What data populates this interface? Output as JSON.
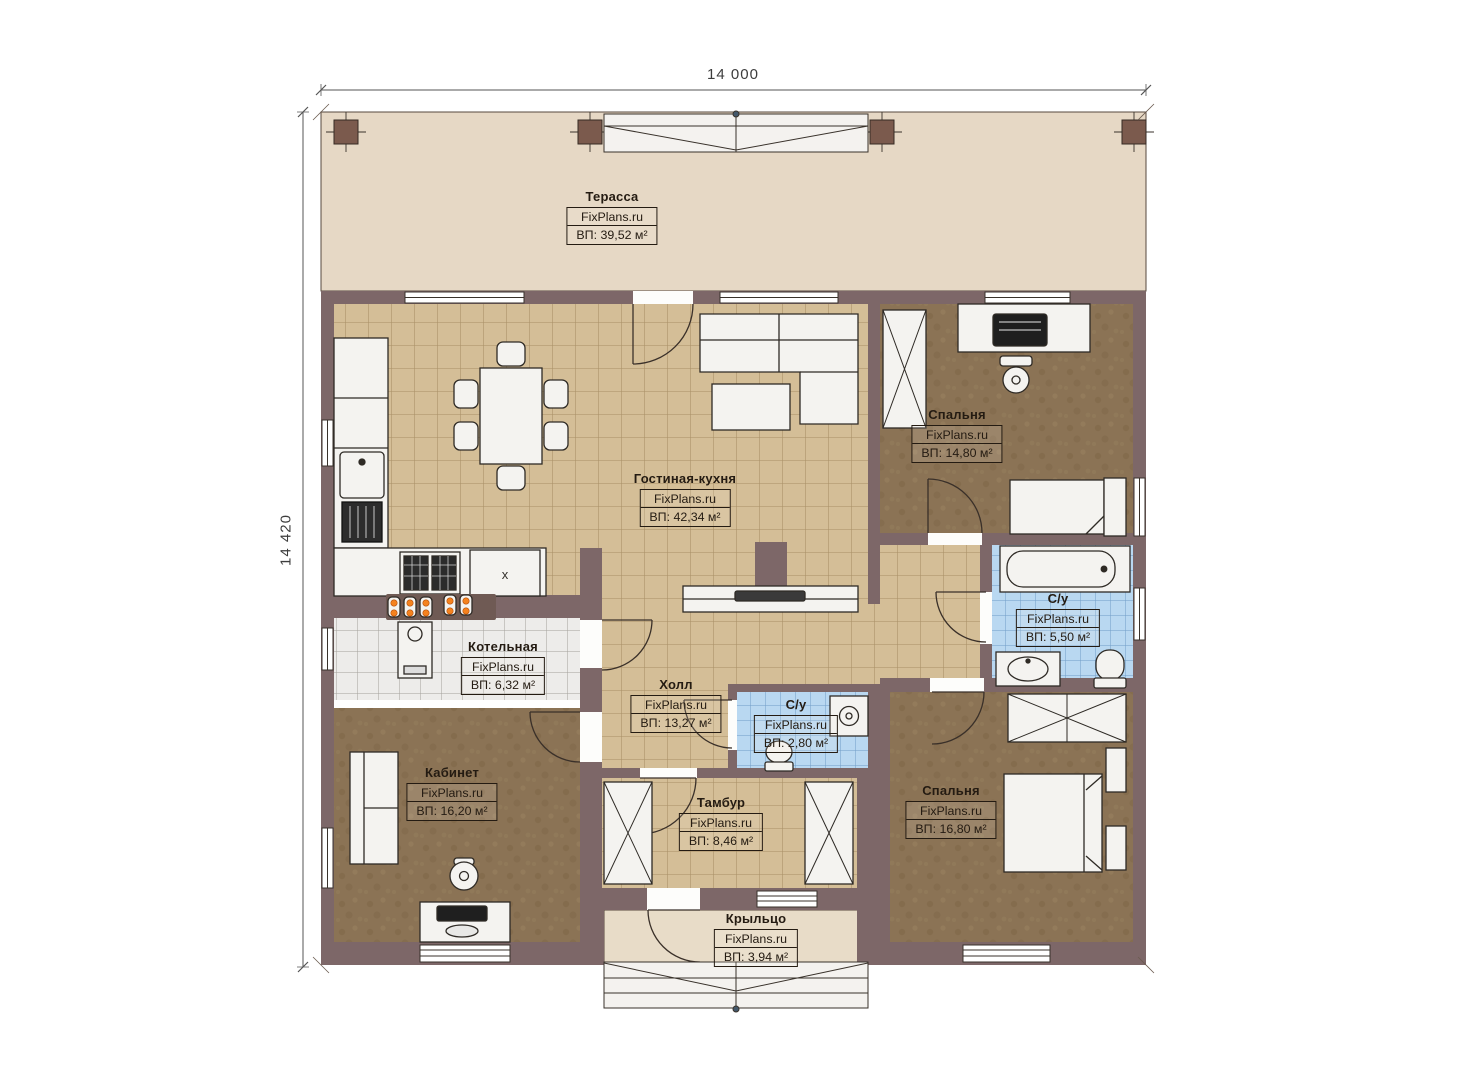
{
  "plan": {
    "watermark": "FixPlans.ru",
    "dimensions": {
      "width": "14 000",
      "height": "14 420"
    },
    "unit_mark": "x",
    "rooms": [
      {
        "id": "terrace",
        "name": "Терасса",
        "area": "ВП: 39,52 м²"
      },
      {
        "id": "living-kitchen",
        "name": "Гостиная-кухня",
        "area": "ВП: 42,34 м²"
      },
      {
        "id": "bedroom-top",
        "name": "Спальня",
        "area": "ВП: 14,80 м²"
      },
      {
        "id": "bathroom-large",
        "name": "С/у",
        "area": "ВП: 5,50 м²"
      },
      {
        "id": "boiler-room",
        "name": "Котельная",
        "area": "ВП: 6,32 м²"
      },
      {
        "id": "hall",
        "name": "Холл",
        "area": "ВП: 13,27 м²"
      },
      {
        "id": "bathroom-small",
        "name": "С/у",
        "area": "ВП: 2,80 м²"
      },
      {
        "id": "office",
        "name": "Кабинет",
        "area": "ВП: 16,20 м²"
      },
      {
        "id": "vestibule",
        "name": "Тамбур",
        "area": "ВП: 8,46 м²"
      },
      {
        "id": "bedroom-bottom",
        "name": "Спальня",
        "area": "ВП: 16,80 м²"
      },
      {
        "id": "porch",
        "name": "Крыльцо",
        "area": "ВП: 3,94 м²"
      }
    ],
    "colors": {
      "wall": "#7d6768",
      "column": "#7b5a4d",
      "terrace_floor": "#e6d8c5",
      "porch_floor": "#e8dcc8",
      "tile_tan": "#d4be97",
      "tile_gray": "#edecea",
      "tile_blue": "#b9d8f1",
      "carpet": "#8b7355",
      "accent_orange": "#f5821e"
    }
  }
}
